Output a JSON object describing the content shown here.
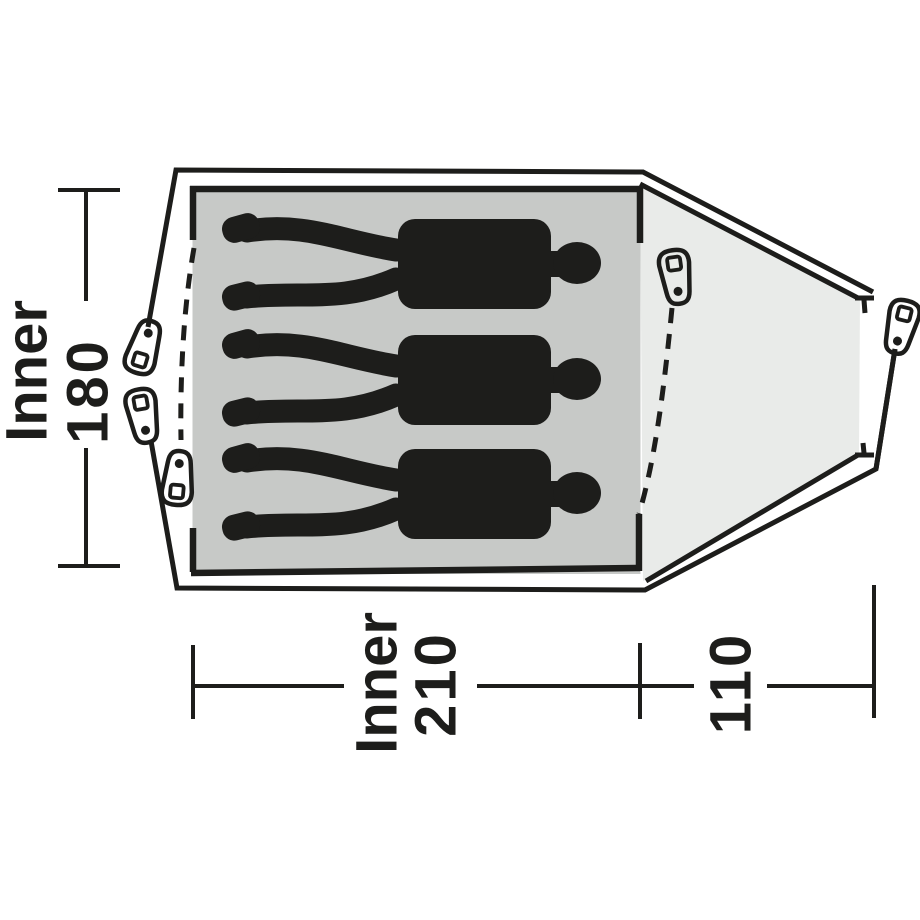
{
  "diagram": {
    "type": "tent-floorplan-top-view",
    "labels": {
      "inner_width": {
        "prefix": "Inner",
        "value": "180"
      },
      "inner_length": {
        "prefix": "Inner",
        "value": "210"
      },
      "porch_depth": {
        "value": "110"
      }
    },
    "occupants": {
      "count": 3,
      "description": "sleeping-person-silhouette"
    },
    "features": {
      "peg_points": 5,
      "door_zips": 2
    },
    "colors": {
      "outline": "#1d1d1b",
      "inner_area": "#c7c9c7",
      "porch_area": "#e9ebe9",
      "peg_fill": "#d2d4d2",
      "background": "#ffffff"
    }
  }
}
